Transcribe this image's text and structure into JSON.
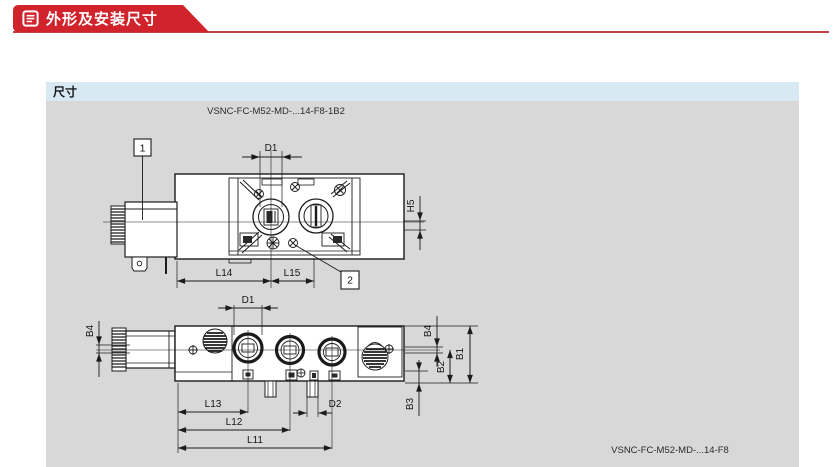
{
  "header": {
    "title": "外形及安装尺寸",
    "icon": "document-lines-icon",
    "banner_color": "#d0232c",
    "rule_color": "#c24345"
  },
  "section": {
    "label": "尺寸",
    "label_bar_color": "#d9e9f4",
    "panel_color": "#d8d8d8"
  },
  "figures": {
    "top_view": {
      "caption": "VSNC-FC-M52-MD-...14-F8-1B2",
      "balloons": {
        "b1": "1",
        "b2": "2"
      },
      "dims": {
        "d1": "D1",
        "h5": "H5",
        "l14": "L14",
        "l15": "L15"
      }
    },
    "front_view": {
      "caption": "VSNC-FC-M52-MD-...14-F8",
      "dims": {
        "d1": "D1",
        "b4_left": "B4",
        "b4_right": "B4",
        "b1": "B1",
        "b2": "B2",
        "b3": "B3",
        "d2": "D2",
        "l13": "L13",
        "l12": "L12",
        "l11": "L11"
      }
    }
  }
}
